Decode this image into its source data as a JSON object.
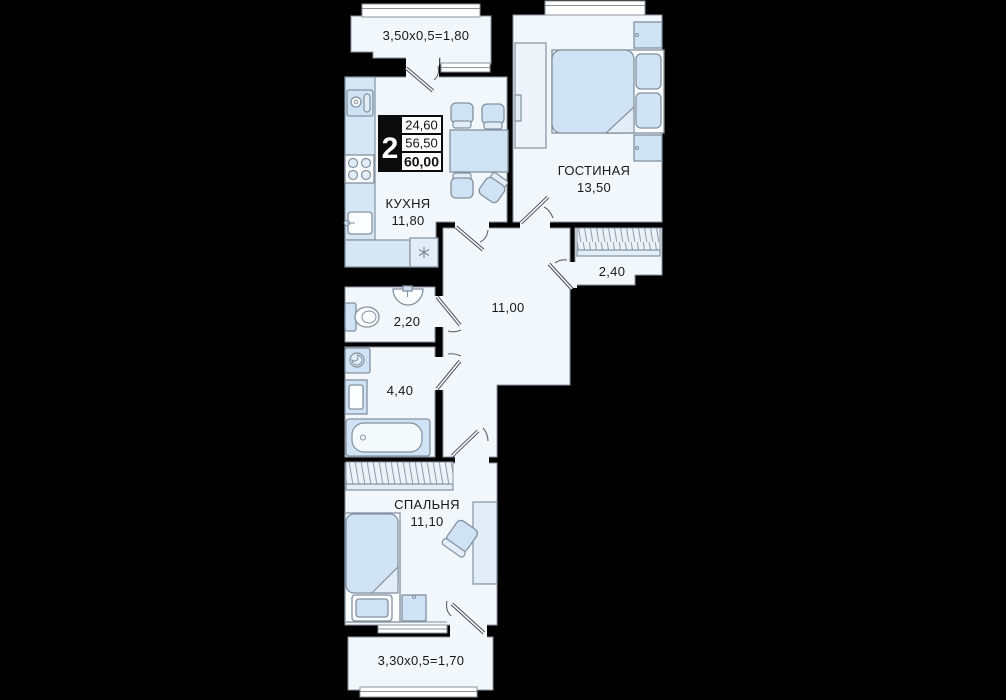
{
  "theme": {
    "background": "#000000",
    "floor": "#f2f7fb",
    "outline": "#8b939c",
    "furniture": "#cfe3f5",
    "furniture_stroke": "#8291a0",
    "text": "#16181b"
  },
  "info_badge": {
    "room_count": "2",
    "values": [
      "24,60",
      "56,50",
      "60,00"
    ]
  },
  "rooms": [
    {
      "id": "balcony-top",
      "dimension": "3,50x0,5=1,80"
    },
    {
      "id": "kitchen",
      "name": "КУХНЯ",
      "area": "11,80"
    },
    {
      "id": "living-room",
      "name": "ГОСТИНАЯ",
      "area": "13,50"
    },
    {
      "id": "wardrobe",
      "area": "2,40"
    },
    {
      "id": "hallway",
      "area": "11,00"
    },
    {
      "id": "toilet",
      "area": "2,20"
    },
    {
      "id": "bathroom",
      "area": "4,40"
    },
    {
      "id": "bedroom",
      "name": "СПАЛЬНЯ",
      "area": "11,10"
    },
    {
      "id": "balcony-bottom",
      "dimension": "3,30x0,5=1,70"
    }
  ]
}
